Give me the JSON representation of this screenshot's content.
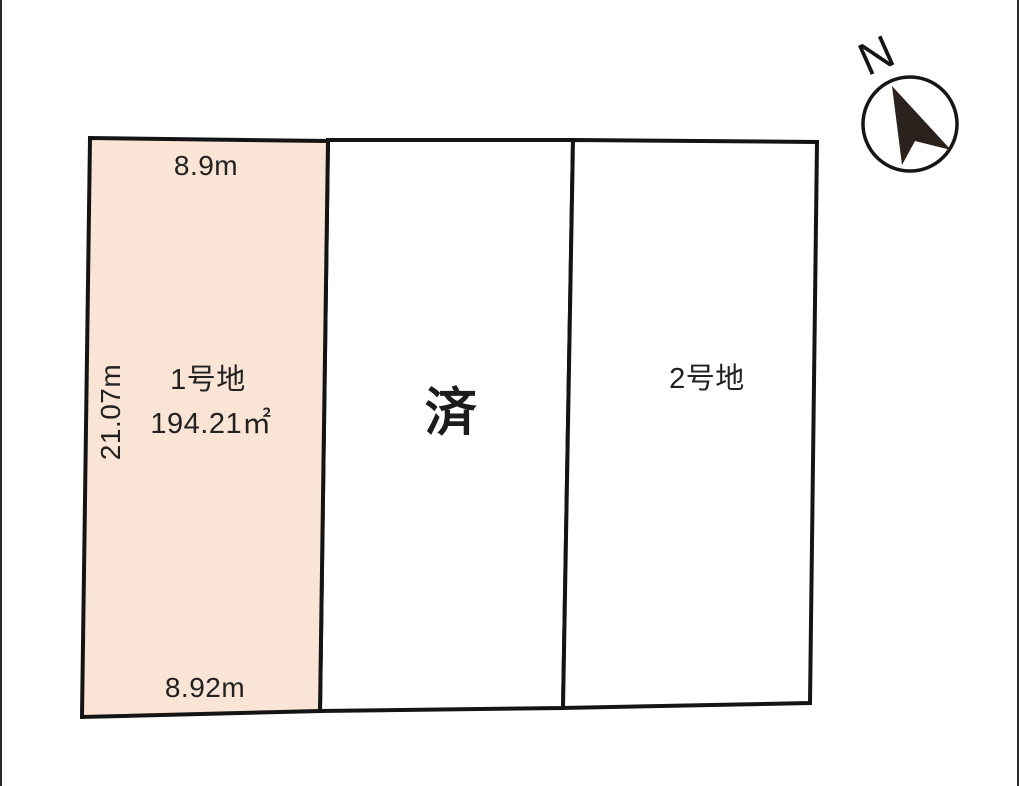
{
  "page": {
    "background": "#ffffff"
  },
  "compass": {
    "label": "N"
  },
  "lots": {
    "lot1": {
      "name": "1号地",
      "area": "194.21㎡",
      "dim_top": "8.9m",
      "dim_left": "21.07m",
      "dim_bottom": "8.92m",
      "fill": "#fae4d5",
      "status": "available"
    },
    "lot_middle": {
      "status_label": "済"
    },
    "lot2": {
      "name": "2号地"
    }
  },
  "colors": {
    "outline": "#141414",
    "lot1_fill": "#fae4d5",
    "lot_fill": "#ffffff",
    "text": "#222222",
    "compass_arrow": "#2b211d"
  }
}
